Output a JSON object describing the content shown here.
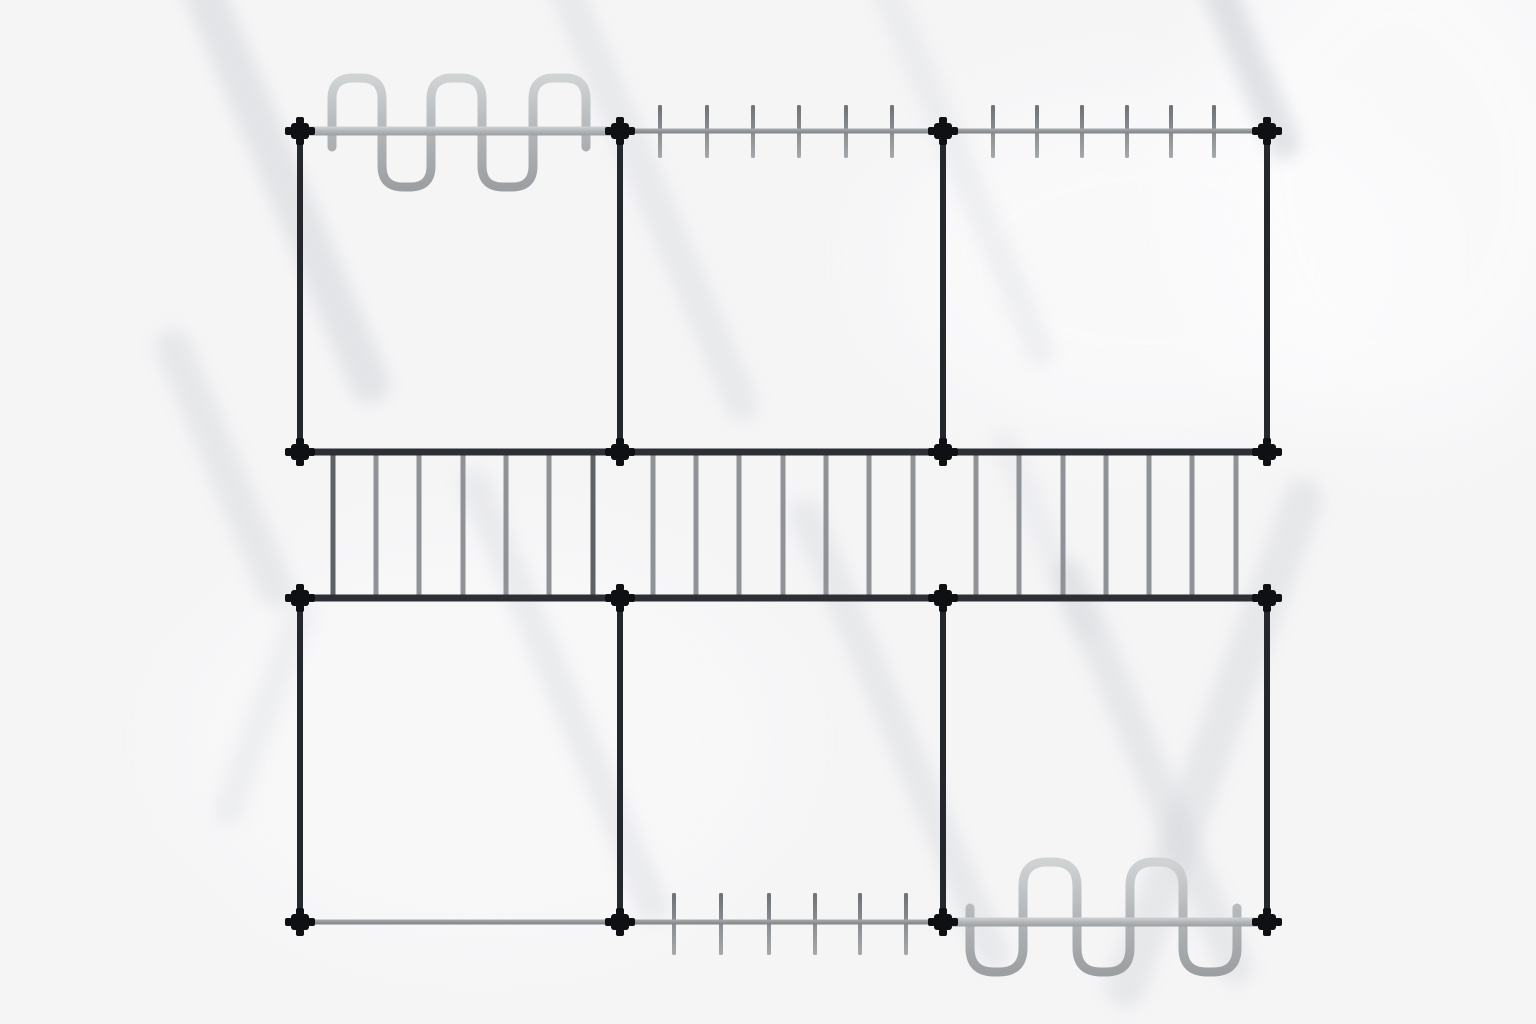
{
  "scene": {
    "canvas": {
      "width": 1536,
      "height": 1024
    },
    "colors": {
      "background": "#f5f5f6",
      "background_highlight": "#fdfdfe",
      "shadow": "#c6c9cf",
      "post_dark": "#24272b",
      "rail_dark": "#2c2f33",
      "rail_gray": "#94979a",
      "tube_light_top": "#d0d3d4",
      "tube_light_bottom": "#9da0a3",
      "tick_top": "#6e7276",
      "tick_bottom": "#a6a9ac",
      "rung_gray": "#8f9296",
      "rung_dark": "#5e6266",
      "node_black": "#0e1013"
    },
    "grid": {
      "columns_x": [
        300,
        620,
        943,
        1267
      ],
      "rows_y": [
        131,
        452,
        598,
        922
      ]
    },
    "nodes": [
      {
        "x": 300,
        "y": 131
      },
      {
        "x": 620,
        "y": 131
      },
      {
        "x": 943,
        "y": 131
      },
      {
        "x": 1267,
        "y": 131
      },
      {
        "x": 300,
        "y": 452
      },
      {
        "x": 620,
        "y": 452
      },
      {
        "x": 943,
        "y": 452
      },
      {
        "x": 1267,
        "y": 452
      },
      {
        "x": 300,
        "y": 598
      },
      {
        "x": 620,
        "y": 598
      },
      {
        "x": 943,
        "y": 598
      },
      {
        "x": 1267,
        "y": 598
      },
      {
        "x": 300,
        "y": 922
      },
      {
        "x": 620,
        "y": 922
      },
      {
        "x": 943,
        "y": 922
      },
      {
        "x": 1267,
        "y": 922
      }
    ],
    "posts": [
      {
        "x": 300,
        "y1": 131,
        "y2": 452
      },
      {
        "x": 620,
        "y1": 131,
        "y2": 452
      },
      {
        "x": 943,
        "y1": 131,
        "y2": 452
      },
      {
        "x": 1267,
        "y1": 131,
        "y2": 452
      },
      {
        "x": 300,
        "y1": 598,
        "y2": 922
      },
      {
        "x": 620,
        "y1": 598,
        "y2": 922
      },
      {
        "x": 943,
        "y1": 598,
        "y2": 922
      },
      {
        "x": 1267,
        "y1": 598,
        "y2": 922
      }
    ],
    "rails": [
      {
        "y": 131,
        "x1": 300,
        "x2": 620,
        "style": "tube"
      },
      {
        "y": 131,
        "x1": 620,
        "x2": 943,
        "style": "gray"
      },
      {
        "y": 131,
        "x1": 943,
        "x2": 1267,
        "style": "gray"
      },
      {
        "y": 452,
        "x1": 300,
        "x2": 1267,
        "style": "dark"
      },
      {
        "y": 598,
        "x1": 300,
        "x2": 1267,
        "style": "dark"
      },
      {
        "y": 922,
        "x1": 300,
        "x2": 620,
        "style": "gray"
      },
      {
        "y": 922,
        "x1": 620,
        "x2": 943,
        "style": "gray"
      },
      {
        "y": 922,
        "x1": 943,
        "x2": 1267,
        "style": "tube"
      }
    ],
    "tick_groups": [
      {
        "rail_y": 131,
        "y1": 105,
        "y2": 158,
        "xs": [
          660,
          707,
          753,
          799,
          846,
          892
        ]
      },
      {
        "rail_y": 131,
        "y1": 105,
        "y2": 158,
        "xs": [
          993,
          1037,
          1082,
          1127,
          1171,
          1214
        ]
      },
      {
        "rail_y": 922,
        "y1": 893,
        "y2": 955,
        "xs": [
          674,
          721,
          769,
          815,
          860,
          906
        ]
      }
    ],
    "ladder": {
      "y1": 452,
      "y2": 598,
      "xs": [
        333,
        376,
        419,
        463,
        506,
        549,
        593,
        653,
        696,
        739,
        783,
        826,
        869,
        913,
        976,
        1019,
        1063,
        1106,
        1149,
        1192,
        1236
      ],
      "dark_xs": [
        333,
        593
      ]
    },
    "serpentines": [
      {
        "id": "top-left",
        "path": "M332,147 L332,99 Q332,78 353,78 L361,78 Q382,78 382,99 L382,166 Q382,187 403,187 L410,187 Q431,187 431,166 L431,99 Q431,78 452,78 L461,78 Q482,78 482,99 L482,166 Q482,187 503,187 L512,187 Q533,187 533,166 L533,99 Q533,78 554,78 L565,78 Q586,78 586,99 L586,147"
      },
      {
        "id": "bottom-right",
        "path": "M970,908 L970,948 Q970,972 994,972 L999,972 Q1023,972 1023,948 L1023,886 Q1023,862 1047,862 L1053,862 Q1077,862 1077,886 L1077,948 Q1077,972 1101,972 L1106,972 Q1130,972 1130,948 L1130,886 Q1130,862 1154,862 L1159,862 Q1183,862 1183,886 L1183,948 Q1183,972 1207,972 L1213,972 Q1237,972 1237,948 L1237,908"
      }
    ],
    "shadow_streaks": [
      {
        "x": 190,
        "y": -40,
        "len": 480,
        "w": 40,
        "opacity": 0.38,
        "angle": -23
      },
      {
        "x": 553,
        "y": -40,
        "len": 500,
        "w": 34,
        "opacity": 0.26,
        "angle": -23
      },
      {
        "x": 878,
        "y": -30,
        "len": 430,
        "w": 30,
        "opacity": 0.2,
        "angle": -23
      },
      {
        "x": 1206,
        "y": -40,
        "len": 215,
        "w": 34,
        "opacity": 0.48,
        "angle": -23
      },
      {
        "x": 166,
        "y": 330,
        "len": 300,
        "w": 36,
        "opacity": 0.3,
        "angle": -23
      },
      {
        "x": 305,
        "y": 600,
        "len": 240,
        "w": 30,
        "opacity": 0.2,
        "angle": 20
      },
      {
        "x": 468,
        "y": 470,
        "len": 490,
        "w": 32,
        "opacity": 0.26,
        "angle": -23
      },
      {
        "x": 800,
        "y": 500,
        "len": 510,
        "w": 32,
        "opacity": 0.28,
        "angle": -23
      },
      {
        "x": 1000,
        "y": 430,
        "len": 230,
        "w": 26,
        "opacity": 0.18,
        "angle": -23
      },
      {
        "x": 1062,
        "y": 560,
        "len": 460,
        "w": 34,
        "opacity": 0.3,
        "angle": -23
      },
      {
        "x": 1310,
        "y": 480,
        "len": 560,
        "w": 40,
        "opacity": 0.3,
        "angle": 20
      }
    ],
    "highlight_blobs": [
      {
        "x": 1150,
        "y": 260,
        "rx": 260,
        "ry": 170,
        "opacity": 0.55
      },
      {
        "x": 480,
        "y": 740,
        "rx": 300,
        "ry": 200,
        "opacity": 0.4
      },
      {
        "x": 1400,
        "y": 180,
        "rx": 200,
        "ry": 260,
        "opacity": 0.6
      }
    ],
    "geometry": {
      "post_width": 6,
      "rail_dark_height": 7,
      "rail_gray_height": 5,
      "tube_thickness": 9,
      "tick_width": 4,
      "rung_width": 5,
      "node": {
        "body_w": 18,
        "body_h": 16,
        "stub": 7,
        "stub_w": 8,
        "radius": 3
      }
    }
  }
}
